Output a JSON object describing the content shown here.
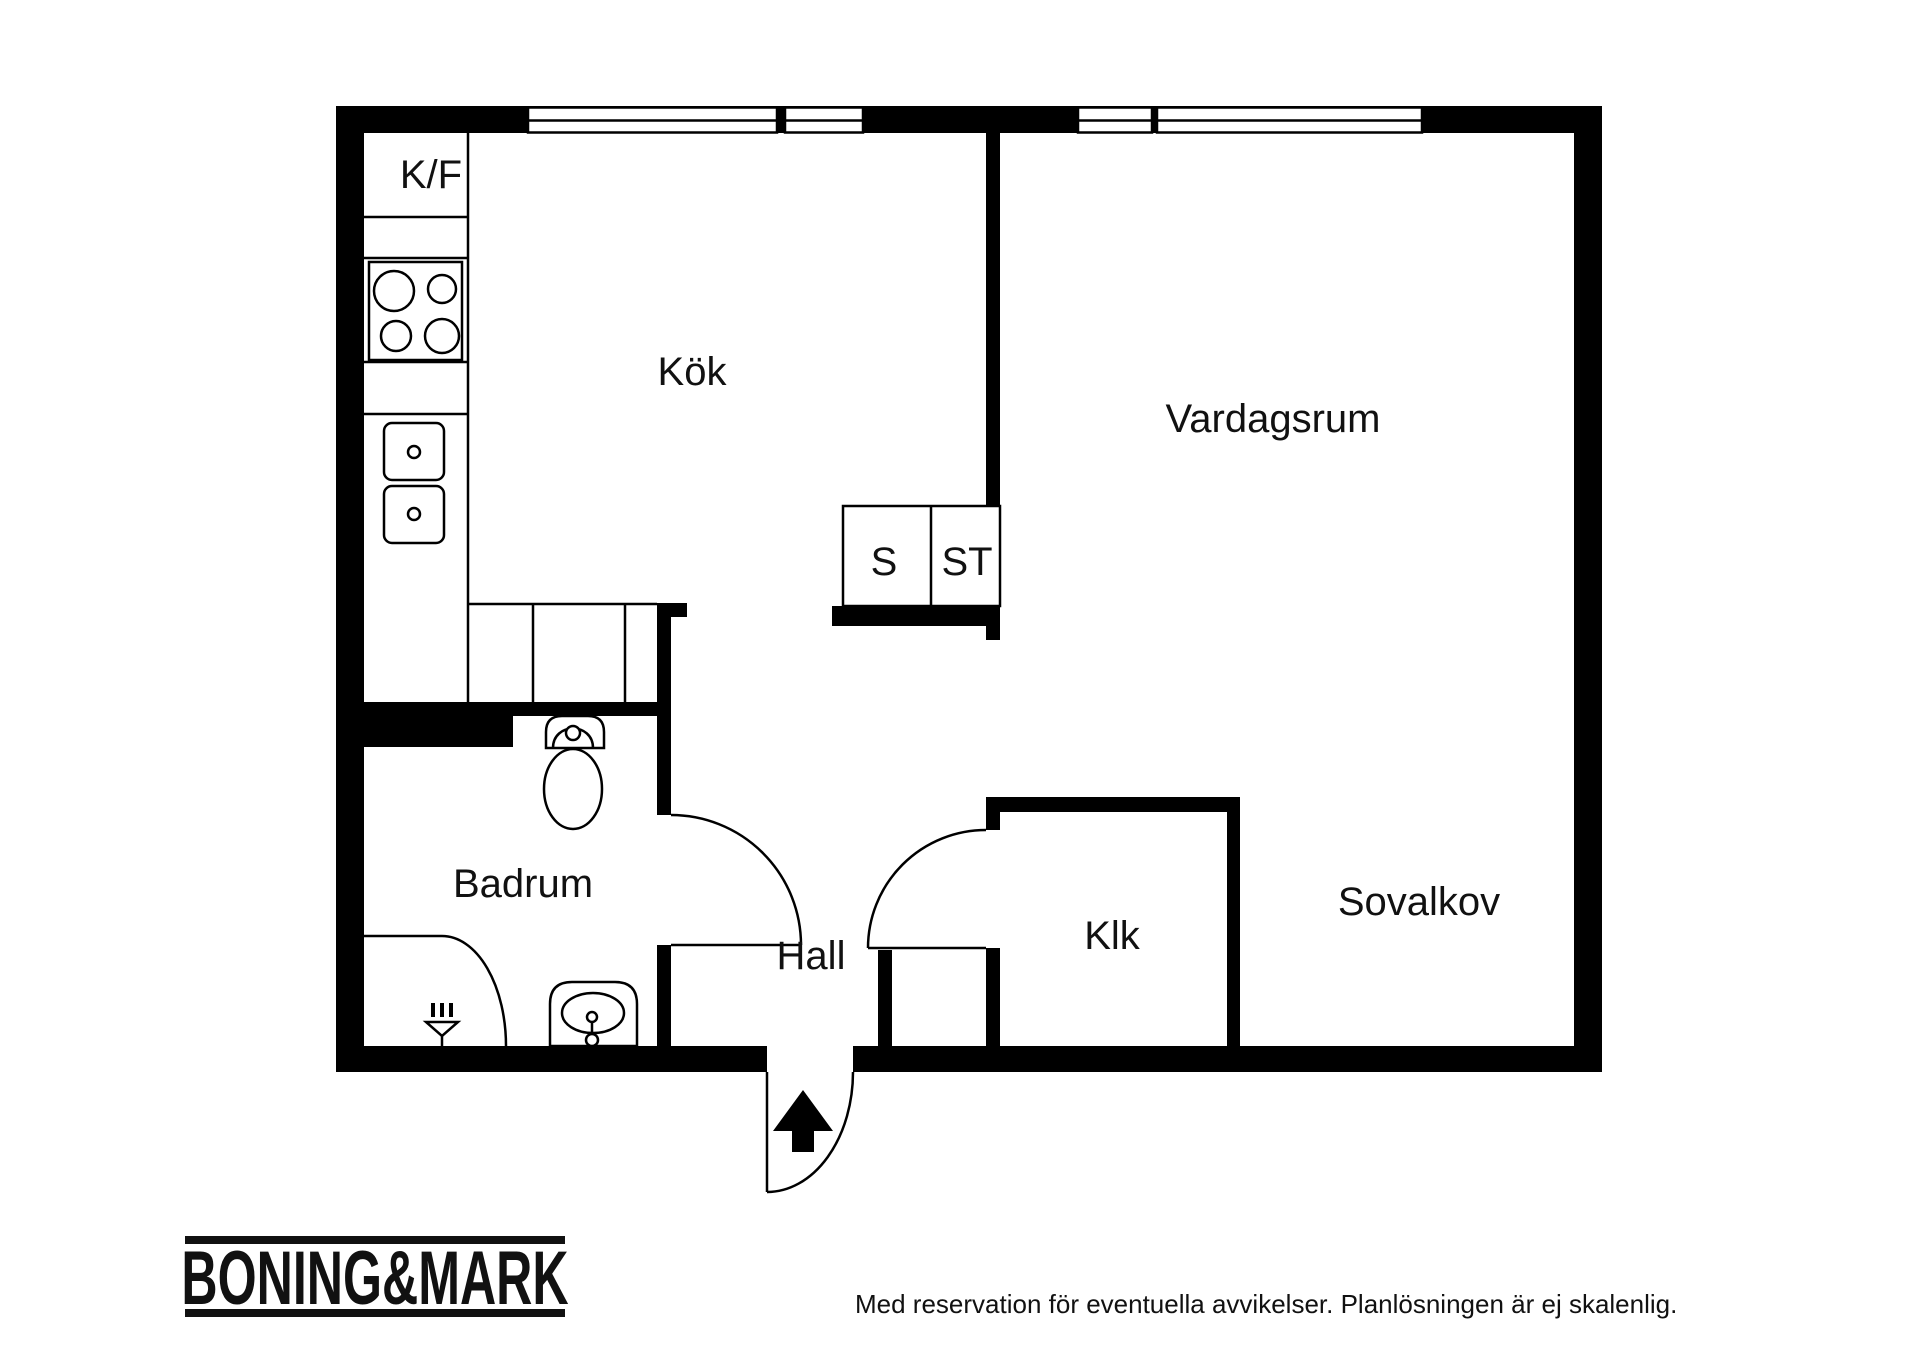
{
  "plan": {
    "labels": {
      "kf": "K/F",
      "kok": "Kök",
      "vardagsrum": "Vardagsrum",
      "s": "S",
      "st": "ST",
      "badrum": "Badrum",
      "hall": "Hall",
      "klk": "Klk",
      "sovalkov": "Sovalkov"
    }
  },
  "footer": {
    "logo": "BONING&MARK",
    "disclaimer": "Med reservation för eventuella avvikelser. Planlösningen är ej skalenlig."
  },
  "colors": {
    "wall": "#000000",
    "background": "#ffffff",
    "text": "#111111"
  }
}
